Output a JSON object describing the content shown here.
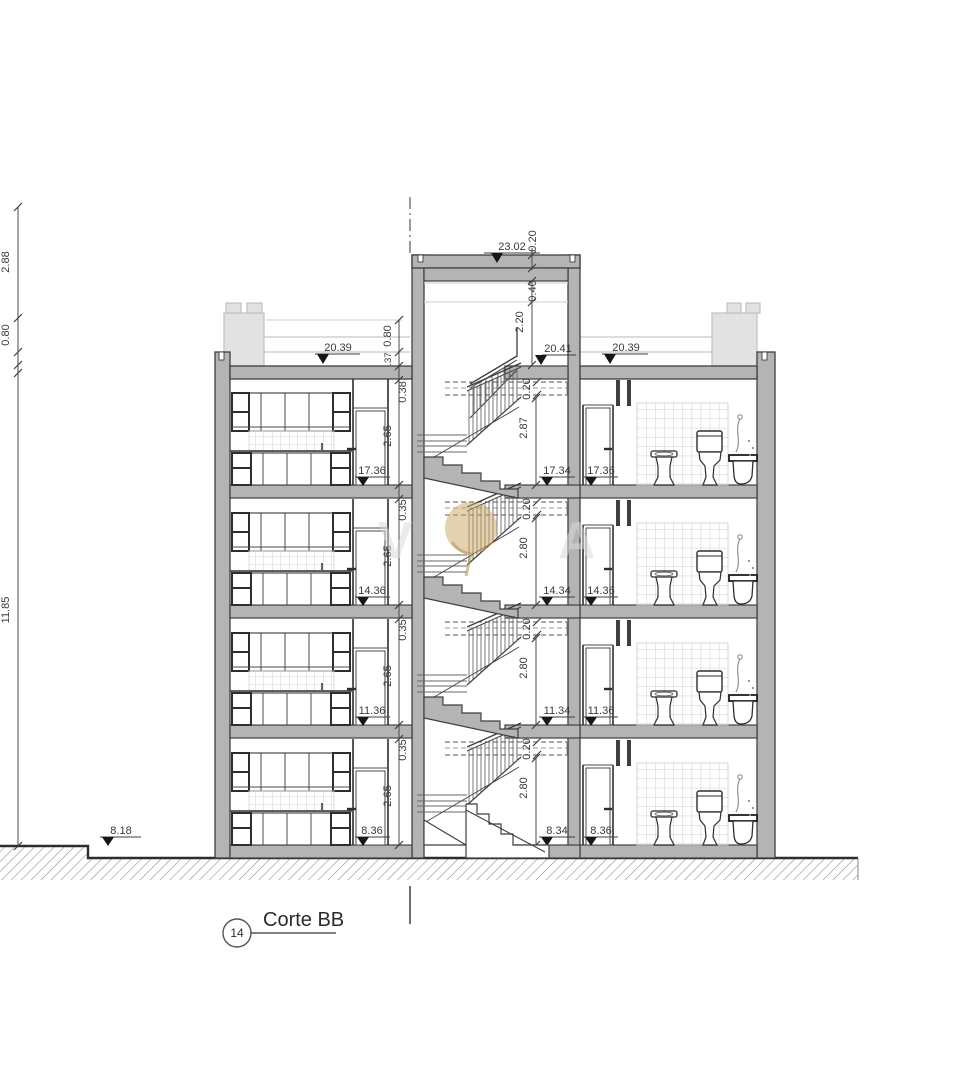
{
  "title": {
    "number": "14",
    "label": "Corte BB"
  },
  "levels": {
    "tower_parapet": "23.02",
    "tower_landing": "20.41",
    "roof_left": "20.39",
    "roof_right": "20.39",
    "left": [
      "17.36",
      "14.36",
      "11.36",
      "8.36"
    ],
    "stair": [
      "17.34",
      "14.34",
      "11.34",
      "8.34"
    ],
    "right": [
      "17.36",
      "14.36",
      "11.36",
      "8.36"
    ],
    "ground": "8.18"
  },
  "dims": {
    "tower_coping": "0.20",
    "tower_roof": "0.40",
    "tower_headroom": "2.20",
    "roof_railing": "0.80",
    "parapet": ".37",
    "roof_slab": "0.38",
    "room_height": "2.65",
    "floor_slab": "0.35",
    "landing_slab": "0.20",
    "stair_top_flight": "2.87",
    "stair_flight": "2.80",
    "left_upper": "2.88",
    "left_mid": "0.80",
    "left_total": "11.85"
  },
  "watermark": {
    "letter_left": "V",
    "letter_right": "A"
  },
  "colors": {
    "wall_gray": "#b4b4b4",
    "edge": "#3f3f3f",
    "roof_elements": "#e2e2e2",
    "watermark_gold": "#c9a35f"
  }
}
